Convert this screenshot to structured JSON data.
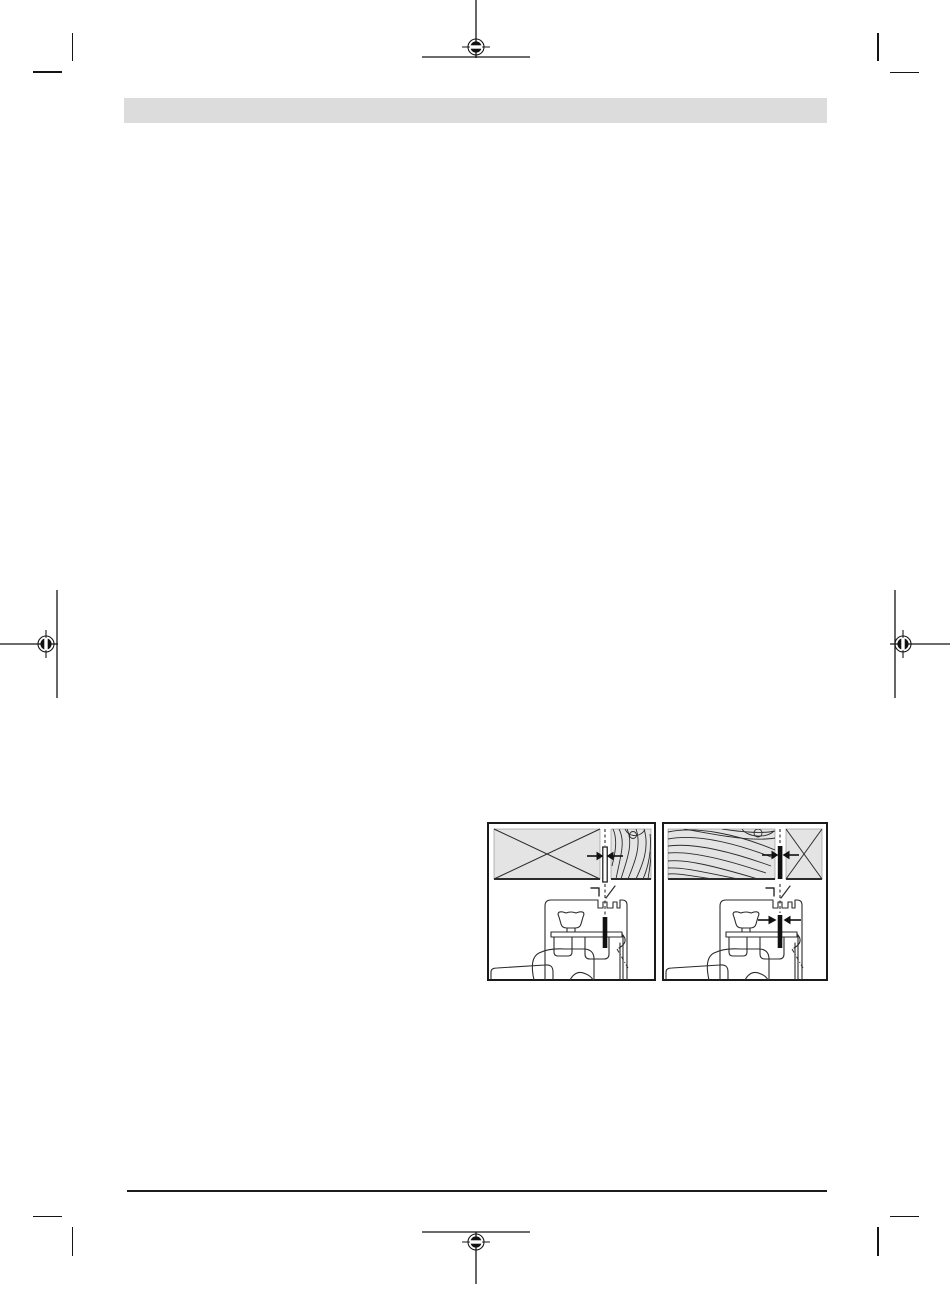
{
  "page": {
    "kind": "print-proof-document-page",
    "background": "#ffffff"
  },
  "header_bar": {
    "color": "#dcdcdc",
    "text": ""
  },
  "footer_rule": {
    "color": "#1c1c1c"
  },
  "print_marks": {
    "color": "#151515",
    "registration_positions": [
      "top-center",
      "left-middle",
      "right-middle",
      "bottom-center"
    ],
    "corner_trim_positions": [
      "top-left",
      "top-right",
      "bottom-left",
      "bottom-right"
    ]
  },
  "figures": {
    "panel_fill": "#e4e4e4",
    "line_color": "#2b2b2b",
    "blade_fill": "#111111",
    "frame_color": "#1a1a1a",
    "items": [
      {
        "name": "blade-alignment-diagram-left",
        "aria": "Saw blade gap between crossed-out panel and wood grain panel, with saw mechanism below"
      },
      {
        "name": "blade-alignment-diagram-right",
        "aria": "Saw blade gap between wood grain panel and crossed-out panel, with saw mechanism and width arrows below"
      }
    ]
  }
}
